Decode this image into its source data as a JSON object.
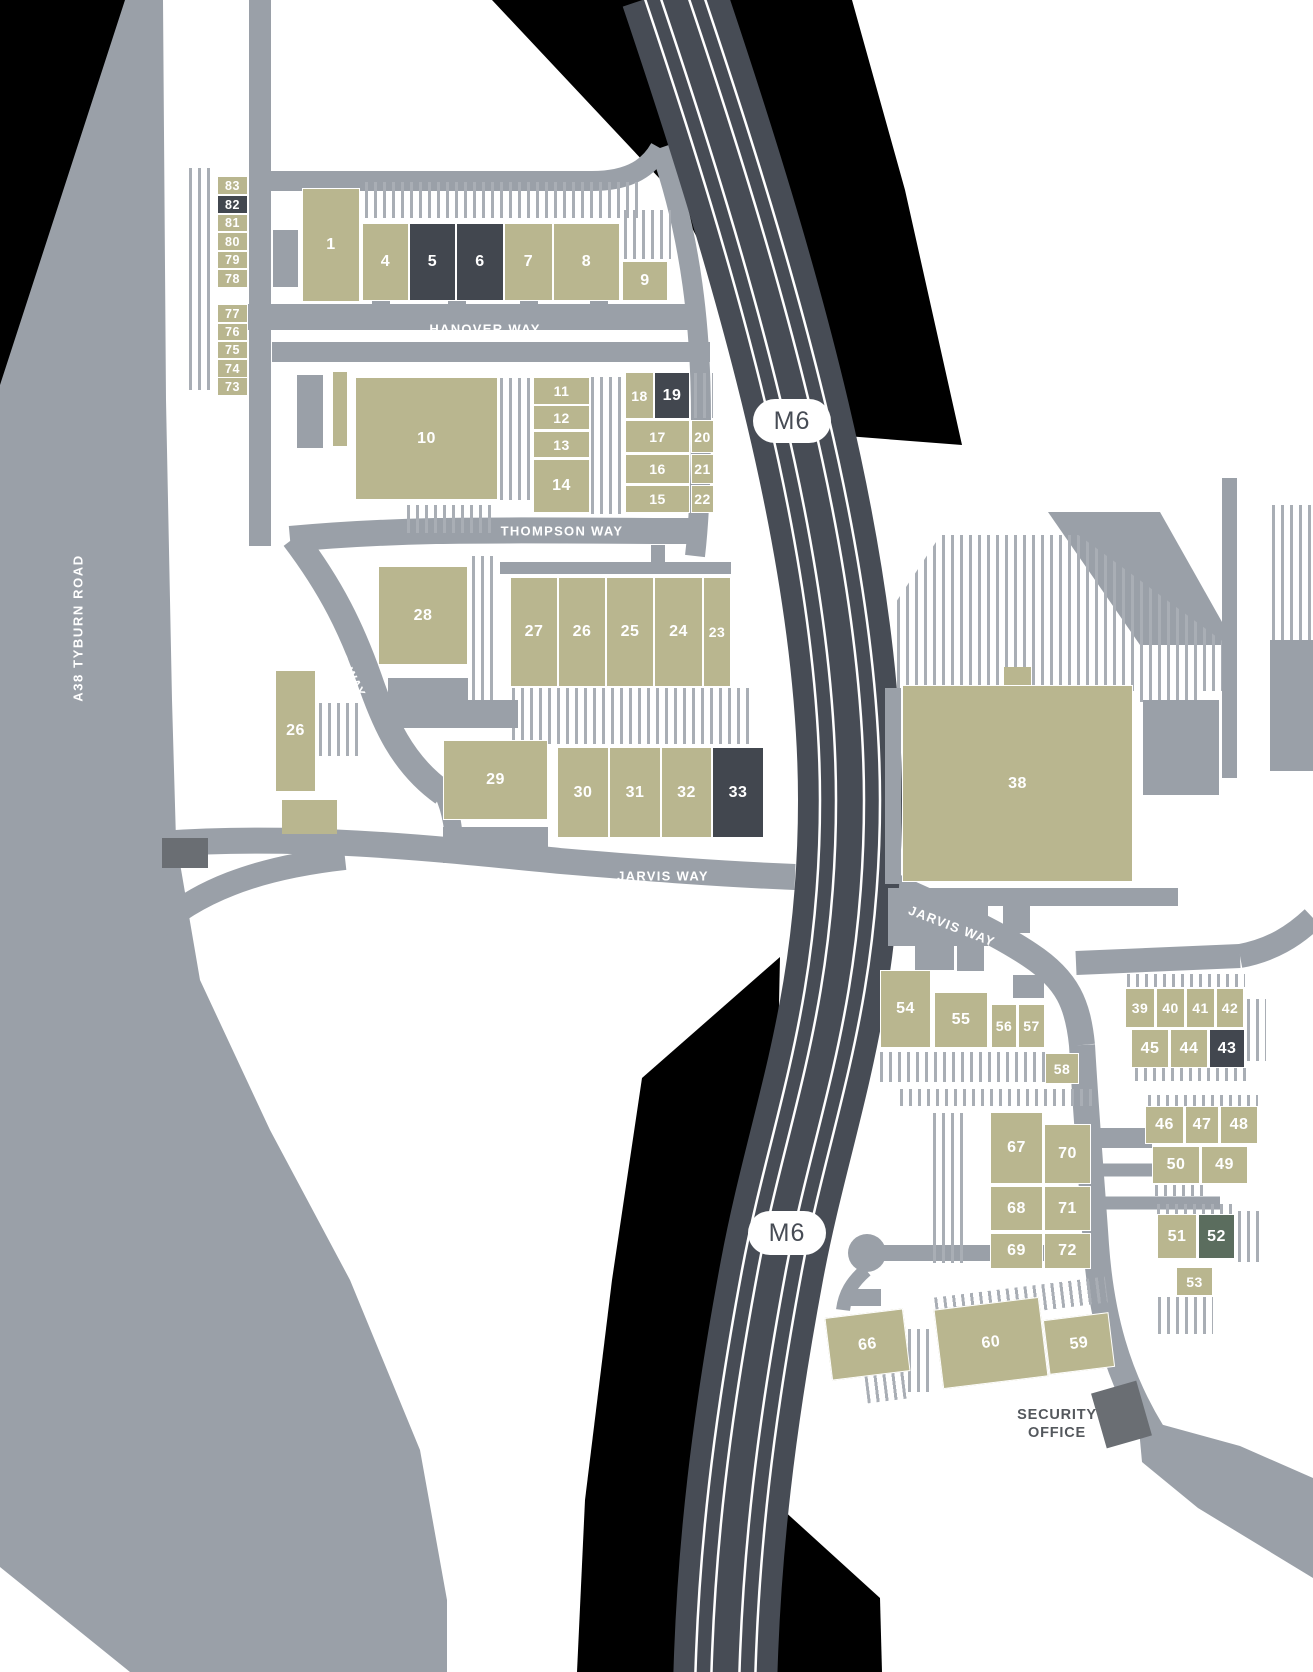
{
  "map": {
    "title": "industrial estate site plan",
    "colors": {
      "background": "#ffffff",
      "road": "#9aa0a8",
      "motorway": "#474c55",
      "motorway_line": "#ffffff",
      "unit": "#b9b68f",
      "unit_dark": "#42474f",
      "unit_green": "#5b6d5e",
      "grey_building": "#6a6e73",
      "hatch_line": "#a9aeb5",
      "black_area": "#000000",
      "security_text": "#54585d"
    },
    "labels": {
      "hanover": "HANOVER WAY",
      "thompson": "THOMPSON WAY",
      "standard": "STANDARD WAY",
      "jarvis_west": "JARVIS WAY",
      "jarvis_east": "JARVIS WAY",
      "a38": "A38 TYBURN ROAD",
      "m6_north": "M6",
      "m6_south": "M6",
      "security_line1": "SECURITY",
      "security_line2": "OFFICE"
    },
    "units": [
      {
        "label": "83",
        "x": 217,
        "y": 176,
        "w": 31,
        "h": 19
      },
      {
        "label": "82",
        "x": 217,
        "y": 195,
        "w": 31,
        "h": 19,
        "v": "dark"
      },
      {
        "label": "81",
        "x": 217,
        "y": 214,
        "w": 31,
        "h": 18
      },
      {
        "label": "80",
        "x": 217,
        "y": 232,
        "w": 31,
        "h": 19
      },
      {
        "label": "79",
        "x": 217,
        "y": 251,
        "w": 31,
        "h": 18
      },
      {
        "label": "78",
        "x": 217,
        "y": 269,
        "w": 31,
        "h": 19
      },
      {
        "label": "77",
        "x": 217,
        "y": 304,
        "w": 31,
        "h": 19
      },
      {
        "label": "76",
        "x": 217,
        "y": 323,
        "w": 31,
        "h": 18
      },
      {
        "label": "75",
        "x": 217,
        "y": 341,
        "w": 31,
        "h": 18
      },
      {
        "label": "74",
        "x": 217,
        "y": 359,
        "w": 31,
        "h": 19
      },
      {
        "label": "73",
        "x": 217,
        "y": 377,
        "w": 31,
        "h": 19
      },
      {
        "label": "1",
        "x": 302,
        "y": 188,
        "w": 58,
        "h": 114
      },
      {
        "label": "4",
        "x": 362,
        "y": 223,
        "w": 47,
        "h": 78
      },
      {
        "label": "5",
        "x": 409,
        "y": 223,
        "w": 47,
        "h": 78,
        "v": "dark"
      },
      {
        "label": "6",
        "x": 456,
        "y": 223,
        "w": 48,
        "h": 78,
        "v": "dark"
      },
      {
        "label": "7",
        "x": 504,
        "y": 223,
        "w": 49,
        "h": 78
      },
      {
        "label": "8",
        "x": 553,
        "y": 223,
        "w": 67,
        "h": 78
      },
      {
        "label": "9",
        "x": 622,
        "y": 261,
        "w": 46,
        "h": 40
      },
      {
        "label": "10",
        "x": 355,
        "y": 377,
        "w": 143,
        "h": 123
      },
      {
        "label": "11",
        "x": 533,
        "y": 377,
        "w": 57,
        "h": 28
      },
      {
        "label": "12",
        "x": 533,
        "y": 405,
        "w": 57,
        "h": 25
      },
      {
        "label": "13",
        "x": 533,
        "y": 431,
        "w": 57,
        "h": 27
      },
      {
        "label": "14",
        "x": 533,
        "y": 459,
        "w": 57,
        "h": 54
      },
      {
        "label": "18",
        "x": 625,
        "y": 372,
        "w": 29,
        "h": 47
      },
      {
        "label": "19",
        "x": 654,
        "y": 372,
        "w": 36,
        "h": 47,
        "v": "dark"
      },
      {
        "label": "17",
        "x": 625,
        "y": 420,
        "w": 65,
        "h": 33
      },
      {
        "label": "20",
        "x": 691,
        "y": 420,
        "w": 23,
        "h": 33
      },
      {
        "label": "16",
        "x": 625,
        "y": 454,
        "w": 65,
        "h": 30
      },
      {
        "label": "21",
        "x": 691,
        "y": 454,
        "w": 23,
        "h": 30
      },
      {
        "label": "15",
        "x": 625,
        "y": 485,
        "w": 65,
        "h": 28
      },
      {
        "label": "22",
        "x": 691,
        "y": 485,
        "w": 23,
        "h": 28
      },
      {
        "label": "28",
        "x": 378,
        "y": 566,
        "w": 90,
        "h": 99
      },
      {
        "label": "27",
        "x": 510,
        "y": 577,
        "w": 48,
        "h": 110
      },
      {
        "label": "26",
        "x": 558,
        "y": 577,
        "w": 48,
        "h": 110
      },
      {
        "label": "25",
        "x": 606,
        "y": 577,
        "w": 48,
        "h": 110
      },
      {
        "label": "24",
        "x": 654,
        "y": 577,
        "w": 49,
        "h": 110
      },
      {
        "label": "23",
        "x": 703,
        "y": 577,
        "w": 28,
        "h": 110
      },
      {
        "label": "26",
        "x": 275,
        "y": 670,
        "w": 41,
        "h": 122
      },
      {
        "label": "29",
        "x": 443,
        "y": 740,
        "w": 105,
        "h": 80
      },
      {
        "label": "30",
        "x": 557,
        "y": 747,
        "w": 52,
        "h": 91
      },
      {
        "label": "31",
        "x": 609,
        "y": 747,
        "w": 52,
        "h": 91
      },
      {
        "label": "32",
        "x": 661,
        "y": 747,
        "w": 51,
        "h": 91
      },
      {
        "label": "33",
        "x": 712,
        "y": 747,
        "w": 52,
        "h": 91,
        "v": "dark"
      },
      {
        "label": "38",
        "x": 902,
        "y": 685,
        "w": 231,
        "h": 197
      },
      {
        "label": "54",
        "x": 880,
        "y": 970,
        "w": 51,
        "h": 78
      },
      {
        "label": "55",
        "x": 934,
        "y": 992,
        "w": 54,
        "h": 56
      },
      {
        "label": "56",
        "x": 991,
        "y": 1004,
        "w": 26,
        "h": 44
      },
      {
        "label": "57",
        "x": 1018,
        "y": 1004,
        "w": 27,
        "h": 44
      },
      {
        "label": "58",
        "x": 1045,
        "y": 1053,
        "w": 34,
        "h": 31
      },
      {
        "label": "39",
        "x": 1125,
        "y": 988,
        "w": 30,
        "h": 40
      },
      {
        "label": "40",
        "x": 1156,
        "y": 988,
        "w": 29,
        "h": 40
      },
      {
        "label": "41",
        "x": 1186,
        "y": 988,
        "w": 29,
        "h": 40
      },
      {
        "label": "42",
        "x": 1216,
        "y": 988,
        "w": 28,
        "h": 40
      },
      {
        "label": "45",
        "x": 1131,
        "y": 1029,
        "w": 38,
        "h": 39
      },
      {
        "label": "44",
        "x": 1170,
        "y": 1029,
        "w": 38,
        "h": 39
      },
      {
        "label": "43",
        "x": 1209,
        "y": 1029,
        "w": 36,
        "h": 39,
        "v": "dark"
      },
      {
        "label": "46",
        "x": 1145,
        "y": 1106,
        "w": 39,
        "h": 38
      },
      {
        "label": "47",
        "x": 1185,
        "y": 1106,
        "w": 34,
        "h": 38
      },
      {
        "label": "48",
        "x": 1220,
        "y": 1106,
        "w": 38,
        "h": 38
      },
      {
        "label": "50",
        "x": 1152,
        "y": 1146,
        "w": 48,
        "h": 38
      },
      {
        "label": "49",
        "x": 1201,
        "y": 1146,
        "w": 47,
        "h": 38
      },
      {
        "label": "51",
        "x": 1157,
        "y": 1214,
        "w": 40,
        "h": 45
      },
      {
        "label": "52",
        "x": 1198,
        "y": 1214,
        "w": 37,
        "h": 45,
        "v": "green"
      },
      {
        "label": "53",
        "x": 1176,
        "y": 1267,
        "w": 37,
        "h": 29
      },
      {
        "label": "67",
        "x": 990,
        "y": 1112,
        "w": 53,
        "h": 72
      },
      {
        "label": "70",
        "x": 1044,
        "y": 1124,
        "w": 47,
        "h": 60
      },
      {
        "label": "68",
        "x": 990,
        "y": 1186,
        "w": 53,
        "h": 45
      },
      {
        "label": "71",
        "x": 1044,
        "y": 1186,
        "w": 47,
        "h": 45
      },
      {
        "label": "69",
        "x": 990,
        "y": 1233,
        "w": 53,
        "h": 36
      },
      {
        "label": "72",
        "x": 1044,
        "y": 1233,
        "w": 47,
        "h": 36
      },
      {
        "label": "66",
        "x": 828,
        "y": 1313,
        "w": 79,
        "h": 63,
        "r": -7
      },
      {
        "label": "60",
        "x": 938,
        "y": 1303,
        "w": 106,
        "h": 80,
        "r": -7
      },
      {
        "label": "59",
        "x": 1046,
        "y": 1316,
        "w": 66,
        "h": 55,
        "r": -7
      }
    ]
  }
}
